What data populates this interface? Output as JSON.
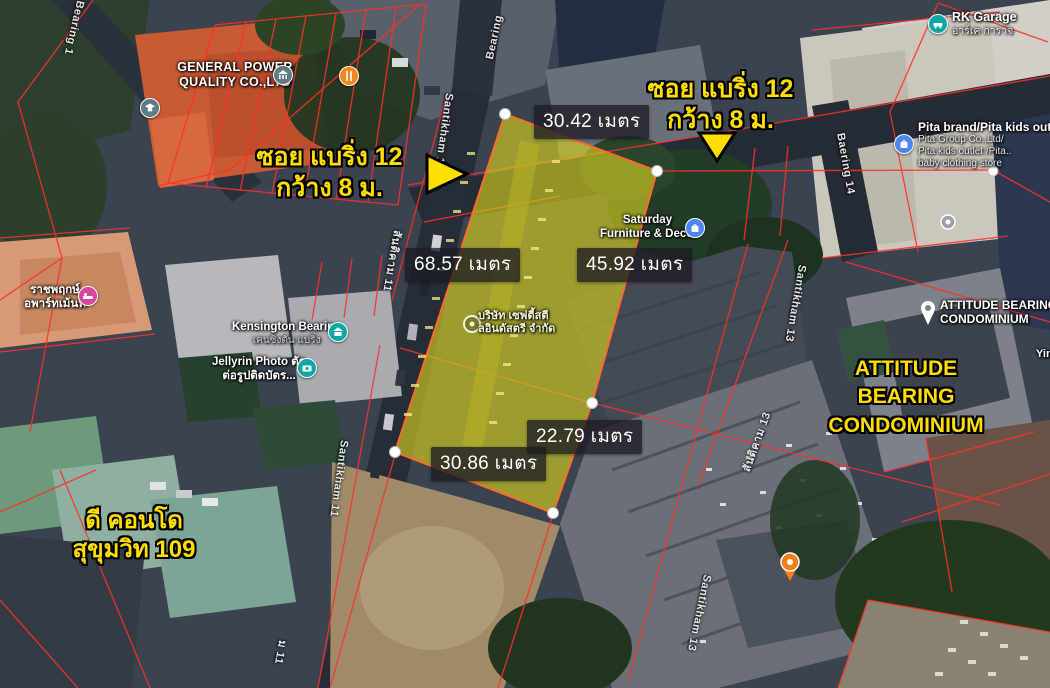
{
  "annotations": {
    "soi_left": {
      "line1": "ซอย แบริ่ง 12",
      "line2": "กว้าง 8 ม."
    },
    "soi_right": {
      "line1": "ซอย แบริ่ง 12",
      "line2": "กว้าง 8 ม."
    },
    "attitude": {
      "line1": "ATTITUDE",
      "line2": "BEARING",
      "line3": "CONDOMINIUM"
    },
    "dcondo": {
      "line1": "ดี คอนโด",
      "line2": "สุขุมวิท 109"
    }
  },
  "measurements": {
    "top": "30.42 เมตร",
    "left": "68.57 เมตร",
    "right": "45.92 เมตร",
    "lower_right": "22.79 เมตร",
    "bottom": "30.86 เมตร"
  },
  "pois": {
    "general_power": {
      "line1": "GENERAL POWER",
      "line2": "QUALITY CO.,LTD"
    },
    "rk_garage": {
      "line1": "RK Garage",
      "line2": "อาร์เค การาจ"
    },
    "pita": {
      "line1": "Pita brand/Pita kids outlet",
      "line2": "Pita Group Co.,Ltd/",
      "line3": "Pita kids outlet /Pita..",
      "line4": "baby clothing store"
    },
    "saturday": {
      "line1": "Saturday",
      "line2": "Furniture & Decor"
    },
    "attitude_condo": {
      "line1": "ATTITUDE BEARING",
      "line2": "CONDOMINIUM"
    },
    "kensington": {
      "line1": "Kensington Bearing",
      "line2": "เคนซิงตัน แบริ่ง"
    },
    "jellyrin": {
      "line1": "Jellyrin Photo ตัด",
      "line2": "ต่อรูปติดบัตร..."
    },
    "ratchaphruek": {
      "line1": "ราชพฤกษ์",
      "line2": "อพาร์ทเม้นท์"
    },
    "company_in_plot": {
      "line1": "บริษัท เซฟตี้สตี",
      "line2": "ลอินดัสตรี จำกัด"
    },
    "yin": "Yin"
  },
  "streets": {
    "bearing_1": "Bearing 1",
    "bearing": "Bearing",
    "santikham_11_upper": "Santikham 11",
    "santikham_11_thai": "สันติคาม 11",
    "santikham_11_lower": "Santikham 11",
    "santikham_11_thai_partial": "ม 11",
    "baering_14": "Baering 14",
    "santikham_13_upper": "Santikham 13",
    "santikham_13_thai": "สันติคาม 13",
    "santikham_13_lower": "Santikham 13"
  },
  "colors": {
    "annotation_yellow": "#ffdf00",
    "plot_fill": "#d9d41f",
    "plot_stroke": "#ff6a2a",
    "boundary_red": "#ff2f28",
    "chip_bg": "rgba(28,28,34,0.78)",
    "chip_text": "#ffffff"
  }
}
